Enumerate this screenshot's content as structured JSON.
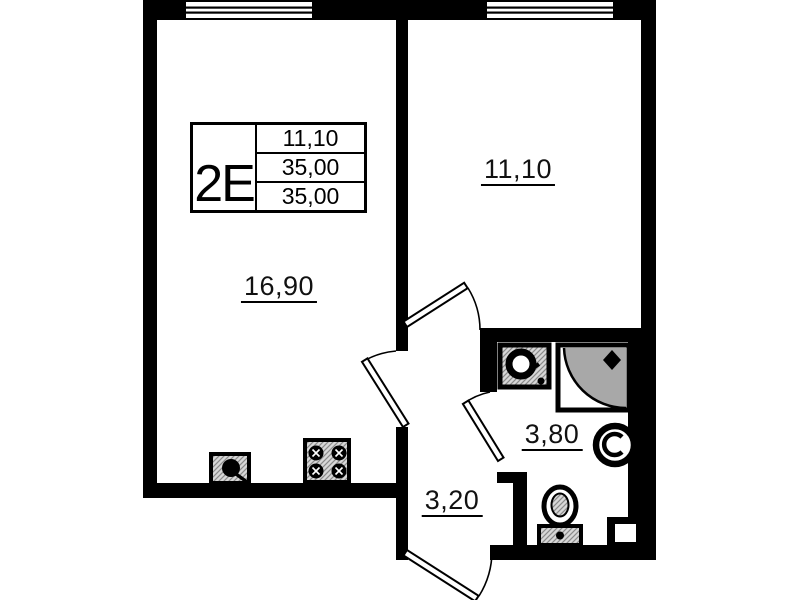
{
  "unit_card": {
    "type_label": "2E",
    "rows": [
      {
        "value": "11,10"
      },
      {
        "value": "35,00"
      },
      {
        "value": "35,00"
      }
    ]
  },
  "rooms": {
    "living": {
      "area": "16,90"
    },
    "bedroom": {
      "area": "11,10"
    },
    "bathroom": {
      "area": "3,80"
    },
    "hall": {
      "area": "3,20"
    }
  },
  "fixtures": [
    "kitchen-sink",
    "stove",
    "bathroom-sink",
    "shower-cabin",
    "water-heater",
    "toilet",
    "vent-shaft",
    "window",
    "door"
  ],
  "colors": {
    "wall": "#000000",
    "background": "#ffffff",
    "fixture_fill": "#d8d8d8",
    "shower_fill": "#a8a8a8"
  }
}
